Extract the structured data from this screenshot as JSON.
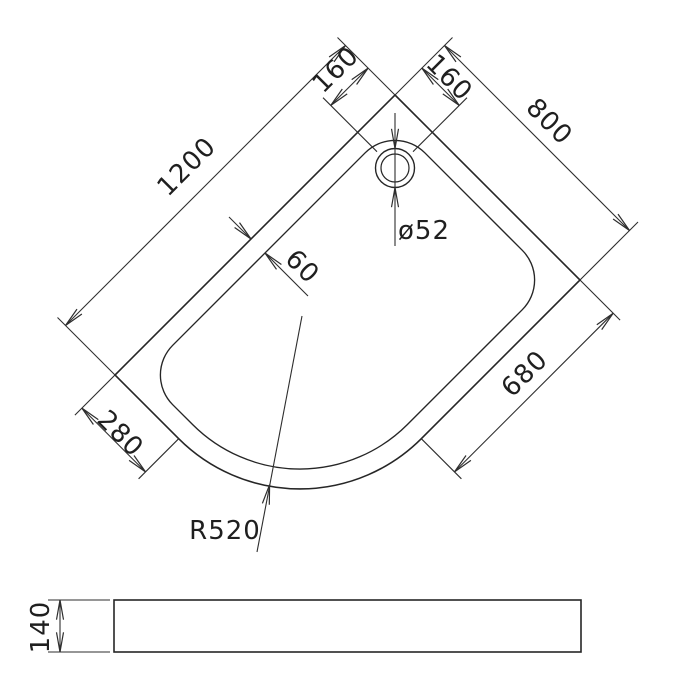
{
  "drawing": {
    "labels": {
      "length": "1200",
      "width": "800",
      "drain_offset_left": "160",
      "drain_offset_right": "160",
      "drain_diameter": "ø52",
      "rim_width": "60",
      "straight_edge_right": "680",
      "straight_edge_left": "280",
      "corner_radius": "R520",
      "tray_height": "140"
    },
    "colors": {
      "line": "#262626",
      "background": "#ffffff"
    }
  }
}
